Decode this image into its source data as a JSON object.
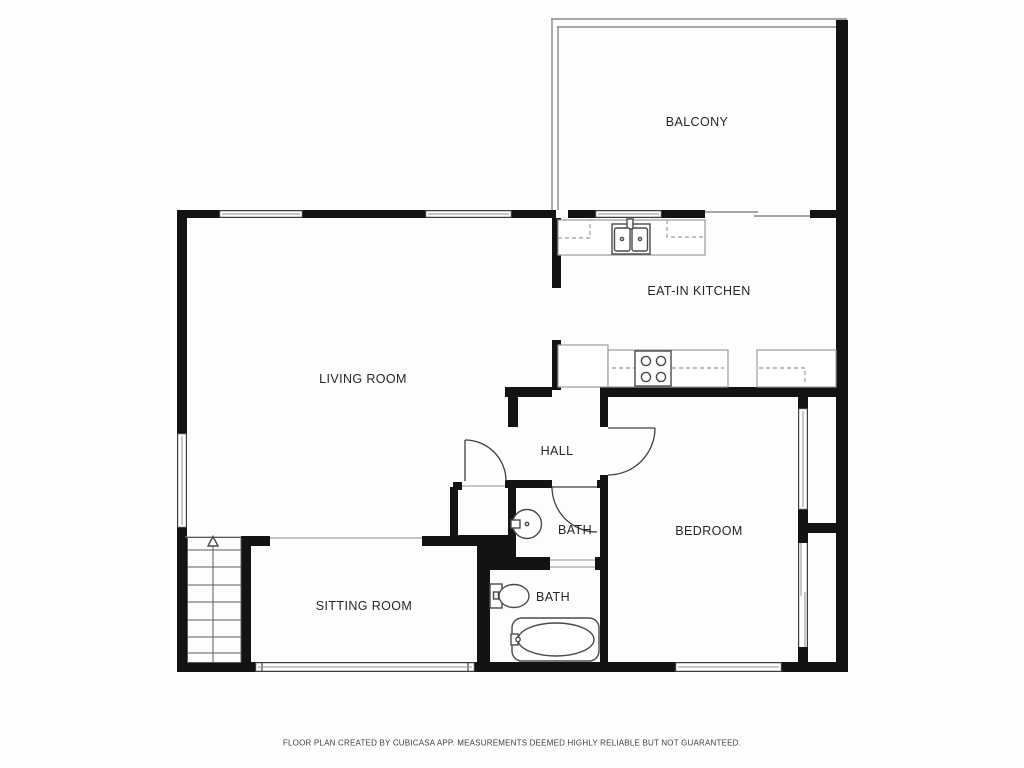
{
  "plan": {
    "creator_note": "FLOOR PLAN CREATED BY CUBICASA APP. MEASUREMENTS DEEMED HIGHLY RELIABLE BUT NOT GUARANTEED.",
    "rooms": [
      {
        "id": "balcony",
        "label": "BALCONY"
      },
      {
        "id": "eat-in-kitchen",
        "label": "EAT-IN KITCHEN"
      },
      {
        "id": "living-room",
        "label": "LIVING ROOM"
      },
      {
        "id": "hall",
        "label": "HALL"
      },
      {
        "id": "bath-upper",
        "label": "BATH"
      },
      {
        "id": "bedroom",
        "label": "BEDROOM"
      },
      {
        "id": "bath-lower",
        "label": "BATH"
      },
      {
        "id": "sitting-room",
        "label": "SITTING ROOM"
      }
    ],
    "fixtures": [
      "double-basin-kitchen-sink",
      "four-burner-stove",
      "kitchen-counters-dashed",
      "round-bathroom-sink",
      "toilet",
      "bathtub",
      "staircase-with-up-arrow",
      "sliding-balcony-door",
      "hinged-interior-doors",
      "windows"
    ],
    "colors": {
      "wall": "#131313",
      "thin_wall_line": "#8a8a8a",
      "window_frame": "#3d3d3d",
      "fixture_line": "#4a4a4a",
      "counter_line": "#9b9b9b",
      "label_text": "#262626",
      "footer_text": "#3d3d3d",
      "background": "#fdfdfd"
    }
  }
}
